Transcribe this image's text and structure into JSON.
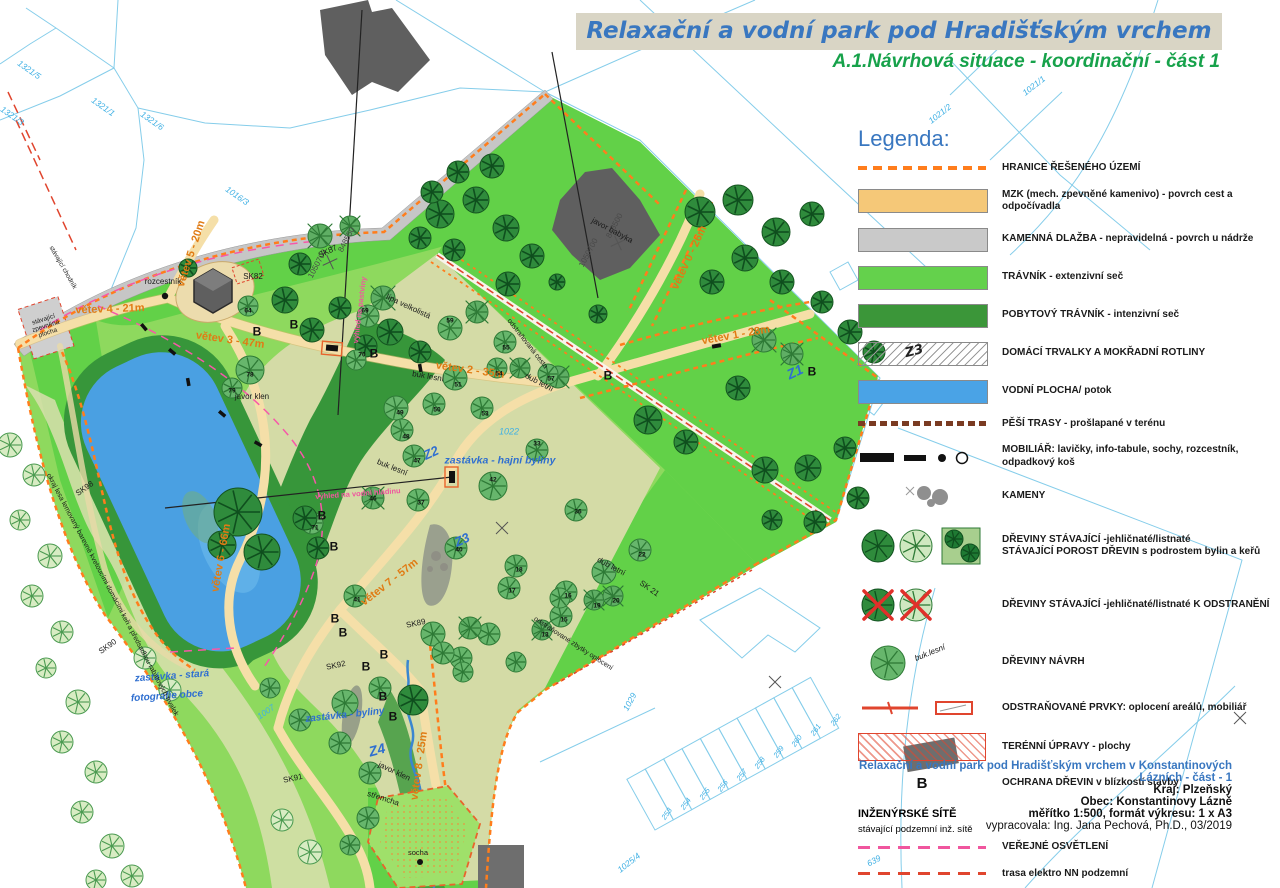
{
  "colors": {
    "title_blue": "#3977c0",
    "subtitle_green": "#17a24b",
    "boundary_orange": "#ff7d1c",
    "grass_light": "#8ed95e",
    "grass_bright": "#62d148",
    "lawn_dark": "#37963a",
    "water_blue": "#4aa0e2",
    "path_tan": "#f5dfa8",
    "cadastral_cyan": "#7fcce8",
    "removal_red": "#e0452e"
  },
  "title": {
    "line1": "Relaxační a vodní park pod Hradišťským vrchem",
    "line2": "A.1.Návrhová situace - koordinační - část 1"
  },
  "legend": {
    "heading": "Legenda:",
    "items": [
      {
        "swatch": "dash-orange",
        "label": "HRANICE ŘEŠENÉHO ÚZEMÍ"
      },
      {
        "swatch": "fill",
        "color": "#f5c878",
        "label": "MZK  (mech. zpevněné kamenivo) - povrch cest a odpočívadla"
      },
      {
        "swatch": "fill",
        "color": "#c9c9c9",
        "label": "KAMENNÁ DLAŽBA - nepravidelná - povrch u nádrže"
      },
      {
        "swatch": "fill",
        "color": "#64d14c",
        "label": "TRÁVNÍK - extenzivní seč"
      },
      {
        "swatch": "fill",
        "color": "#3b9639",
        "label": "POBYTOVÝ TRÁVNÍK - intenzivní seč"
      },
      {
        "swatch": "hatch",
        "tag": "Z3",
        "label": "DOMÁCÍ TRVALKY A MOKŘADNÍ ROTLINY"
      },
      {
        "swatch": "fill",
        "color": "#4aa3e6",
        "label": "VODNÍ PLOCHA/ potok"
      },
      {
        "swatch": "dash-brown",
        "label": "PĚŠÍ TRASY - prošlapané v terénu"
      },
      {
        "swatch": "mobiliar",
        "label": "MOBILIÁŘ: lavičky, info-tabule, sochy, rozcestník, odpadkový koš"
      },
      {
        "swatch": "stones",
        "label": "KAMENY"
      },
      {
        "swatch": "trees",
        "label": "DŘEVINY STÁVAJÍCÍ -jehličnaté/listnaté",
        "label2": "STÁVAJÍCÍ POROST DŘEVIN s podrostem bylin a keřů"
      },
      {
        "swatch": "trees-x",
        "label": "DŘEVINY STÁVAJÍCÍ -jehličnaté/listnaté K ODSTRANĚNÍ"
      },
      {
        "swatch": "tree-new",
        "tag": "buk.lesní",
        "label": "DŘEVINY NÁVRH"
      },
      {
        "swatch": "removed",
        "label": "ODSTRAŇOVANÉ PRVKY: oplocení areálů, mobiliář"
      },
      {
        "swatch": "terrain",
        "label": "TERÉNNÍ ÚPRAVY - plochy"
      },
      {
        "swatch": "letter-b",
        "tag": "B",
        "label": "OCHRANA DŘEVIN v blízkostí stavby"
      }
    ],
    "networks": {
      "heading": "INŽENÝRSKÉ SÍTĚ",
      "subheading": "stávající podzemní inž. sítě",
      "items": [
        {
          "swatch": "dash-pink",
          "label": "VEŘEJNÉ OSVĚTLENÍ"
        },
        {
          "swatch": "dash-red",
          "label": "trasa elektro NN podzemní"
        }
      ]
    }
  },
  "info_block": {
    "line1": "Relaxační a vodní park pod Hradišťským vrchem v Konstantinových",
    "line2": "Lázních - část - 1",
    "line3": "Kraj: Plzeňský",
    "line4": "Obec: Konstantinovy Lázně",
    "line5": "měřítko 1:500, formát výkresu: 1 x A3",
    "line6": "vypracovala: Ing. Jana Pechová, Ph.D., 03/2019"
  },
  "map": {
    "labels": [
      {
        "t": "větev 0 - 26m",
        "x": 690,
        "y": 258,
        "c": "o",
        "s": 11,
        "r": -65
      },
      {
        "t": "větev 1 - 28m",
        "x": 736,
        "y": 336,
        "c": "o",
        "s": 11,
        "r": -10
      },
      {
        "t": "větev 2 - 35m",
        "x": 470,
        "y": 371,
        "c": "o",
        "s": 11,
        "r": 8
      },
      {
        "t": "větev 3 - 47m",
        "x": 230,
        "y": 341,
        "c": "o",
        "s": 11,
        "r": 8
      },
      {
        "t": "větev 4 - 21m",
        "x": 110,
        "y": 310,
        "c": "o",
        "s": 11,
        "r": -2
      },
      {
        "t": "větev 5 - 20m",
        "x": 192,
        "y": 254,
        "c": "o",
        "s": 11,
        "r": -72
      },
      {
        "t": "větev 6 - 66m",
        "x": 222,
        "y": 558,
        "c": "o",
        "s": 11,
        "r": -80
      },
      {
        "t": "větev 7 - 57m",
        "x": 390,
        "y": 583,
        "c": "o",
        "s": 11,
        "r": -38
      },
      {
        "t": "větev 8 - 25m",
        "x": 420,
        "y": 766,
        "c": "o",
        "s": 11,
        "r": -82
      },
      {
        "t": "Z1",
        "x": 795,
        "y": 372,
        "c": "b",
        "s": 14,
        "r": -25
      },
      {
        "t": "Z2",
        "x": 431,
        "y": 453,
        "c": "b",
        "s": 13,
        "r": -25
      },
      {
        "t": "Z3",
        "x": 462,
        "y": 540,
        "c": "b",
        "s": 13,
        "r": -25
      },
      {
        "t": "Z4",
        "x": 377,
        "y": 750,
        "c": "b",
        "s": 14,
        "r": -15
      },
      {
        "t": "zastávka - hajní byliny",
        "x": 500,
        "y": 461,
        "c": "b",
        "s": 10.5,
        "r": 0
      },
      {
        "t": "zastávka - stará",
        "x": 172,
        "y": 677,
        "c": "b",
        "s": 10,
        "r": -4
      },
      {
        "t": "fotografie obce",
        "x": 167,
        "y": 697,
        "c": "b",
        "s": 10,
        "r": -4
      },
      {
        "t": "zastávka - byliny",
        "x": 345,
        "y": 716,
        "c": "b",
        "s": 10,
        "r": -6
      },
      {
        "t": "výhled na vodní hladinu",
        "x": 358,
        "y": 494,
        "c": "p",
        "s": 7.5,
        "r": -4
      },
      {
        "t": "výhled na pastviny",
        "x": 360,
        "y": 310,
        "c": "p",
        "s": 7.5,
        "r": -83
      },
      {
        "t": "1050700",
        "x": 318,
        "y": 264,
        "c": "k",
        "s": 8,
        "r": -62
      },
      {
        "t": "848550",
        "x": 347,
        "y": 240,
        "c": "k",
        "s": 8,
        "r": -62
      },
      {
        "t": "1050700",
        "x": 589,
        "y": 253,
        "c": "k",
        "s": 8,
        "r": -62
      },
      {
        "t": "848500",
        "x": 615,
        "y": 226,
        "c": "k",
        "s": 8,
        "r": -62
      },
      {
        "t": "javor babyka",
        "x": 612,
        "y": 231,
        "c": "n",
        "s": 8,
        "r": 28
      },
      {
        "t": "rozcestník",
        "x": 163,
        "y": 282,
        "c": "n",
        "s": 8,
        "r": 0
      },
      {
        "t": "lípa velkolistá",
        "x": 408,
        "y": 307,
        "c": "n",
        "s": 8,
        "r": 25
      },
      {
        "t": "buk lesní",
        "x": 428,
        "y": 377,
        "c": "n",
        "s": 8,
        "r": 10
      },
      {
        "t": "buk lesní",
        "x": 392,
        "y": 468,
        "c": "n",
        "s": 8,
        "r": 22
      },
      {
        "t": "dub letní",
        "x": 539,
        "y": 383,
        "c": "n",
        "s": 8,
        "r": 28
      },
      {
        "t": "dub letní",
        "x": 611,
        "y": 567,
        "c": "n",
        "s": 8,
        "r": 28
      },
      {
        "t": "javor klen",
        "x": 252,
        "y": 397,
        "c": "n",
        "s": 8,
        "r": 0
      },
      {
        "t": "javor klen",
        "x": 394,
        "y": 772,
        "c": "n",
        "s": 8,
        "r": 25
      },
      {
        "t": "střemcha",
        "x": 383,
        "y": 799,
        "c": "n",
        "s": 8,
        "r": 18
      },
      {
        "t": "socha",
        "x": 418,
        "y": 853,
        "c": "n",
        "s": 7.5,
        "r": 0
      },
      {
        "t": "SK87",
        "x": 328,
        "y": 252,
        "c": "n",
        "s": 8,
        "r": -25
      },
      {
        "t": "SK82",
        "x": 253,
        "y": 277,
        "c": "n",
        "s": 8,
        "r": 0
      },
      {
        "t": "SK89",
        "x": 416,
        "y": 624,
        "c": "n",
        "s": 8,
        "r": -12
      },
      {
        "t": "SK92",
        "x": 336,
        "y": 666,
        "c": "n",
        "s": 8,
        "r": -12
      },
      {
        "t": "SK91",
        "x": 293,
        "y": 779,
        "c": "n",
        "s": 8,
        "r": -12
      },
      {
        "t": "SK90",
        "x": 108,
        "y": 647,
        "c": "n",
        "s": 8,
        "r": -35
      },
      {
        "t": "SK98",
        "x": 85,
        "y": 489,
        "c": "n",
        "s": 8,
        "r": -35
      },
      {
        "t": "SK 21",
        "x": 649,
        "y": 589,
        "c": "n",
        "s": 8,
        "r": 35
      },
      {
        "t": "odstraňované zbytky oplocení",
        "x": 573,
        "y": 644,
        "c": "n",
        "s": 7,
        "r": 33
      },
      {
        "t": "odstraňovaná cesta",
        "x": 527,
        "y": 344,
        "c": "n",
        "s": 7,
        "r": 52
      },
      {
        "t": "stávající\nzpevněná\nplocha",
        "x": 46,
        "y": 327,
        "c": "n",
        "s": 6.5,
        "r": -18
      },
      {
        "t": "stávající chodník",
        "x": 62,
        "y": 268,
        "c": "n",
        "s": 6.5,
        "r": 60
      },
      {
        "t": "okraj lesa lemovaný barevně kvetoucími domácími keři a předsadbou rabatových trvalek",
        "x": 112,
        "y": 595,
        "c": "n",
        "s": 7,
        "r": 62
      },
      {
        "t": "B",
        "x": 257,
        "y": 332,
        "c": "B",
        "s": 12,
        "r": 0
      },
      {
        "t": "B",
        "x": 294,
        "y": 325,
        "c": "B",
        "s": 12,
        "r": 0
      },
      {
        "t": "B",
        "x": 374,
        "y": 354,
        "c": "B",
        "s": 12,
        "r": 0
      },
      {
        "t": "B",
        "x": 608,
        "y": 376,
        "c": "B",
        "s": 12,
        "r": 0
      },
      {
        "t": "B",
        "x": 812,
        "y": 372,
        "c": "B",
        "s": 12,
        "r": 0
      },
      {
        "t": "B",
        "x": 322,
        "y": 516,
        "c": "B",
        "s": 12,
        "r": 0
      },
      {
        "t": "B",
        "x": 334,
        "y": 547,
        "c": "B",
        "s": 12,
        "r": 0
      },
      {
        "t": "B",
        "x": 335,
        "y": 619,
        "c": "B",
        "s": 12,
        "r": 0
      },
      {
        "t": "B",
        "x": 343,
        "y": 633,
        "c": "B",
        "s": 12,
        "r": 0
      },
      {
        "t": "B",
        "x": 366,
        "y": 667,
        "c": "B",
        "s": 12,
        "r": 0
      },
      {
        "t": "B",
        "x": 384,
        "y": 655,
        "c": "B",
        "s": 12,
        "r": 0
      },
      {
        "t": "B",
        "x": 383,
        "y": 697,
        "c": "B",
        "s": 12,
        "r": 0
      },
      {
        "t": "B",
        "x": 393,
        "y": 717,
        "c": "B",
        "s": 12,
        "r": 0
      },
      {
        "t": "78",
        "x": 250,
        "y": 376,
        "c": "t",
        "s": 6.5,
        "r": 0
      },
      {
        "t": "79",
        "x": 232,
        "y": 392,
        "c": "t",
        "s": 6.5,
        "r": 0
      },
      {
        "t": "64",
        "x": 248,
        "y": 312,
        "c": "t",
        "s": 6.5,
        "r": 0
      },
      {
        "t": "69",
        "x": 365,
        "y": 312,
        "c": "t",
        "s": 6.5,
        "r": 0
      },
      {
        "t": "70",
        "x": 362,
        "y": 356,
        "c": "t",
        "s": 6.5,
        "r": 0
      },
      {
        "t": "59",
        "x": 450,
        "y": 322,
        "c": "t",
        "s": 6.5,
        "r": 0
      },
      {
        "t": "55",
        "x": 506,
        "y": 349,
        "c": "t",
        "s": 6.5,
        "r": 0
      },
      {
        "t": "54",
        "x": 499,
        "y": 375,
        "c": "t",
        "s": 6.5,
        "r": 0
      },
      {
        "t": "51",
        "x": 458,
        "y": 386,
        "c": "t",
        "s": 6.5,
        "r": 0
      },
      {
        "t": "50",
        "x": 437,
        "y": 411,
        "c": "t",
        "s": 6.5,
        "r": 0
      },
      {
        "t": "49",
        "x": 400,
        "y": 414,
        "c": "t",
        "s": 6.5,
        "r": 0
      },
      {
        "t": "48",
        "x": 406,
        "y": 438,
        "c": "t",
        "s": 6.5,
        "r": 0
      },
      {
        "t": "47",
        "x": 417,
        "y": 462,
        "c": "t",
        "s": 6.5,
        "r": 0
      },
      {
        "t": "53",
        "x": 485,
        "y": 415,
        "c": "t",
        "s": 6.5,
        "r": 0
      },
      {
        "t": "33",
        "x": 537,
        "y": 445,
        "c": "t",
        "s": 6.5,
        "r": 0
      },
      {
        "t": "42",
        "x": 493,
        "y": 481,
        "c": "t",
        "s": 6.5,
        "r": 0
      },
      {
        "t": "57",
        "x": 551,
        "y": 380,
        "c": "t",
        "s": 6.5,
        "r": 0
      },
      {
        "t": "37",
        "x": 421,
        "y": 504,
        "c": "t",
        "s": 6.5,
        "r": 0
      },
      {
        "t": "40",
        "x": 459,
        "y": 551,
        "c": "t",
        "s": 6.5,
        "r": 0
      },
      {
        "t": "36",
        "x": 578,
        "y": 513,
        "c": "t",
        "s": 6.5,
        "r": 0
      },
      {
        "t": "18",
        "x": 519,
        "y": 571,
        "c": "t",
        "s": 6.5,
        "r": 0
      },
      {
        "t": "17",
        "x": 512,
        "y": 592,
        "c": "t",
        "s": 6.5,
        "r": 0
      },
      {
        "t": "16",
        "x": 568,
        "y": 597,
        "c": "t",
        "s": 6.5,
        "r": 0
      },
      {
        "t": "15",
        "x": 564,
        "y": 621,
        "c": "t",
        "s": 6.5,
        "r": 0
      },
      {
        "t": "41",
        "x": 357,
        "y": 601,
        "c": "t",
        "s": 6.5,
        "r": 0
      },
      {
        "t": "71",
        "x": 315,
        "y": 529,
        "c": "t",
        "s": 6.5,
        "r": 0
      },
      {
        "t": "13",
        "x": 545,
        "y": 636,
        "c": "t",
        "s": 6.5,
        "r": 0
      },
      {
        "t": "19",
        "x": 597,
        "y": 607,
        "c": "t",
        "s": 6.5,
        "r": 0
      },
      {
        "t": "20",
        "x": 616,
        "y": 602,
        "c": "t",
        "s": 6.5,
        "r": 0
      },
      {
        "t": "22",
        "x": 642,
        "y": 556,
        "c": "t",
        "s": 6.5,
        "r": 0
      },
      {
        "t": "46",
        "x": 373,
        "y": 500,
        "c": "t",
        "s": 6.5,
        "r": 0
      },
      {
        "t": "1321/5",
        "x": 29,
        "y": 70,
        "c": "c",
        "s": 8.5,
        "r": 35
      },
      {
        "t": "1321/3",
        "x": 12,
        "y": 116,
        "c": "c",
        "s": 8.5,
        "r": 35
      },
      {
        "t": "1321/1",
        "x": 103,
        "y": 107,
        "c": "c",
        "s": 8.5,
        "r": 35
      },
      {
        "t": "1321/6",
        "x": 152,
        "y": 121,
        "c": "c",
        "s": 8.5,
        "r": 35
      },
      {
        "t": "1016/3",
        "x": 237,
        "y": 196,
        "c": "c",
        "s": 8.5,
        "r": 35
      },
      {
        "t": "1021/1",
        "x": 1034,
        "y": 86,
        "c": "c",
        "s": 8.5,
        "r": -38
      },
      {
        "t": "1021/2",
        "x": 940,
        "y": 114,
        "c": "c",
        "s": 8.5,
        "r": -38
      },
      {
        "t": "1022",
        "x": 509,
        "y": 432,
        "c": "c",
        "s": 9,
        "r": 0
      },
      {
        "t": "1029",
        "x": 630,
        "y": 702,
        "c": "c",
        "s": 8.5,
        "r": -62
      },
      {
        "t": "1007",
        "x": 266,
        "y": 712,
        "c": "c",
        "s": 8.5,
        "r": -35
      },
      {
        "t": "1025/4",
        "x": 629,
        "y": 863,
        "c": "c",
        "s": 8.5,
        "r": -38
      },
      {
        "t": "639",
        "x": 874,
        "y": 861,
        "c": "c",
        "s": 8.5,
        "r": -28
      },
      {
        "t": "253",
        "x": 667,
        "y": 814,
        "c": "c",
        "s": 7.5,
        "r": -55
      },
      {
        "t": "254",
        "x": 686,
        "y": 804,
        "c": "c",
        "s": 7.5,
        "r": -55
      },
      {
        "t": "255",
        "x": 705,
        "y": 794,
        "c": "c",
        "s": 7.5,
        "r": -55
      },
      {
        "t": "256",
        "x": 723,
        "y": 786,
        "c": "c",
        "s": 7.5,
        "r": -55
      },
      {
        "t": "257",
        "x": 742,
        "y": 775,
        "c": "c",
        "s": 7.5,
        "r": -55
      },
      {
        "t": "258",
        "x": 760,
        "y": 763,
        "c": "c",
        "s": 7.5,
        "r": -55
      },
      {
        "t": "259",
        "x": 779,
        "y": 752,
        "c": "c",
        "s": 7.5,
        "r": -55
      },
      {
        "t": "260",
        "x": 797,
        "y": 741,
        "c": "c",
        "s": 7.5,
        "r": -55
      },
      {
        "t": "261",
        "x": 816,
        "y": 730,
        "c": "c",
        "s": 7.5,
        "r": -55
      },
      {
        "t": "262",
        "x": 836,
        "y": 720,
        "c": "c",
        "s": 7.5,
        "r": -55
      }
    ]
  }
}
